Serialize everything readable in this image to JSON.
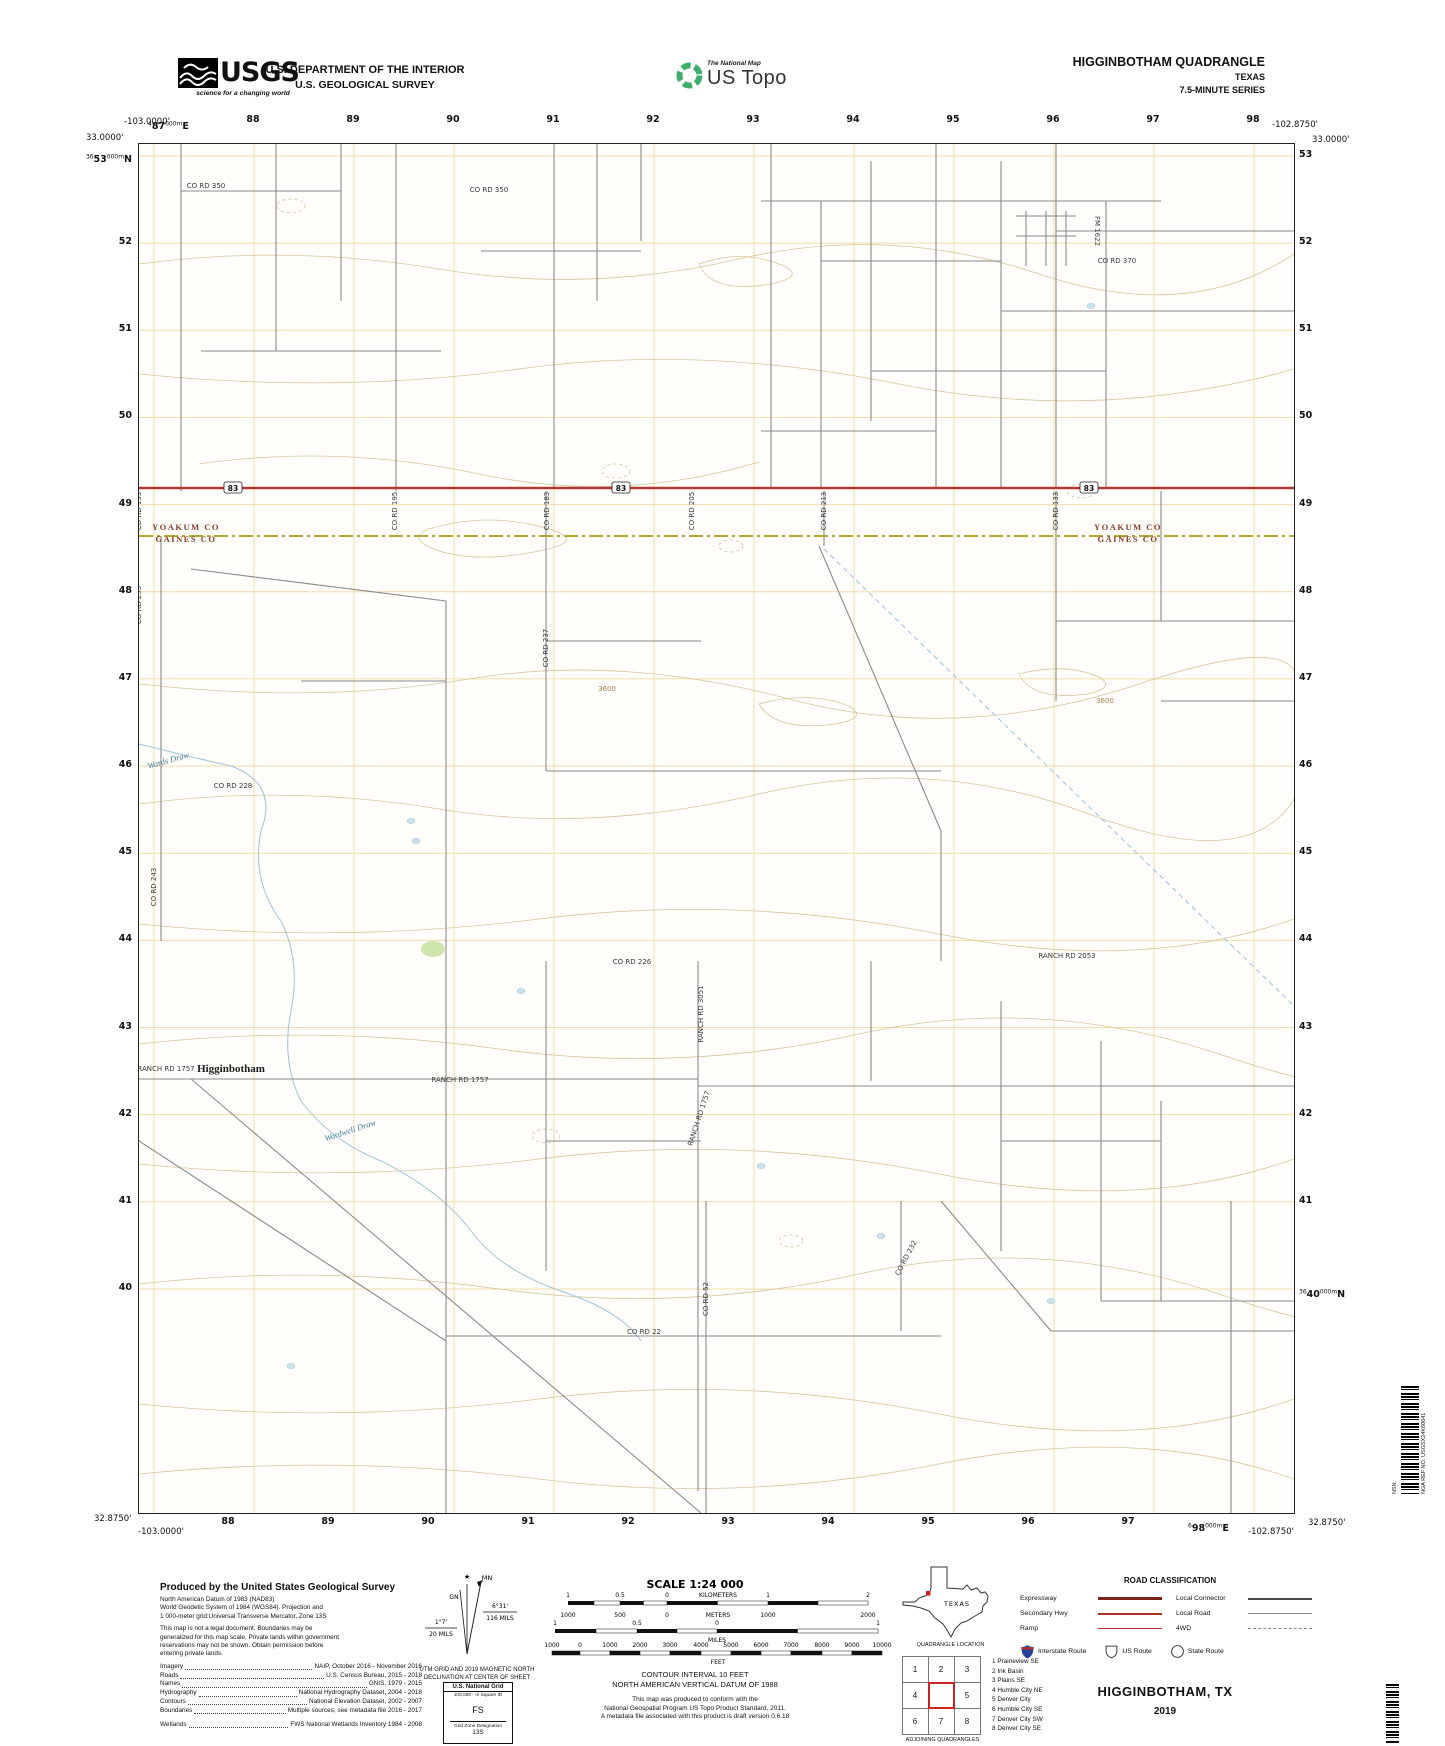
{
  "header": {
    "usgs_word": "USGS",
    "usgs_tagline": "science for a changing world",
    "dept_line1": "U.S. DEPARTMENT OF THE INTERIOR",
    "dept_line2": "U.S. GEOLOGICAL SURVEY",
    "ustopo_brand": "The National Map",
    "ustopo_name": "US Topo",
    "quad_title": "HIGGINBOTHAM QUADRANGLE",
    "quad_state": "TEXAS",
    "quad_series": "7.5-MINUTE SERIES"
  },
  "map": {
    "corners": {
      "top_left_lon": "-103.0000'",
      "top_left_lat": "33.0000'",
      "top_right_lon": "-102.8750'",
      "top_right_lat": "33.0000'",
      "bottom_left_lat": "32.8750'",
      "bottom_left_lon": "-103.0000'",
      "bottom_right_lon": "-102.8750'",
      "bottom_right_lat": "32.8750'"
    },
    "full_labels": {
      "top_left_easting": {
        "pre": "4",
        "big": "87",
        "sup": "000m",
        "post": "E"
      },
      "left_top_northing": {
        "pre": "36",
        "big": "53",
        "sup": "000m",
        "post": "N"
      },
      "bottom_right_easting": {
        "pre": "6",
        "big": "98",
        "sup": "000m",
        "post": "E"
      },
      "right_bottom_northing": {
        "pre": "36",
        "big": "40",
        "sup": "000m",
        "post": "N"
      }
    },
    "top_eastings": [
      "88",
      "89",
      "90",
      "91",
      "92",
      "93",
      "94",
      "95",
      "96",
      "97",
      "98"
    ],
    "bottom_eastings": [
      "88",
      "89",
      "90",
      "91",
      "92",
      "93",
      "94",
      "95",
      "96",
      "97"
    ],
    "left_northings": [
      "52",
      "51",
      "50",
      "49",
      "48",
      "47",
      "46",
      "45",
      "44",
      "43",
      "42",
      "41",
      "40"
    ],
    "right_northings": [
      "53",
      "52",
      "51",
      "50",
      "49",
      "48",
      "47",
      "46",
      "45",
      "44",
      "43",
      "42",
      "41"
    ],
    "route_shields": [
      {
        "label": "83",
        "x": 232,
        "y": 487
      },
      {
        "label": "83",
        "x": 620,
        "y": 487
      },
      {
        "label": "83",
        "x": 1088,
        "y": 487
      }
    ],
    "labels": [
      {
        "t": "CO RD 350",
        "x": 205,
        "y": 187,
        "r": 0,
        "c": "road"
      },
      {
        "t": "CO RD 350",
        "x": 488,
        "y": 191,
        "r": 0,
        "c": "road"
      },
      {
        "t": "FM 1622",
        "x": 1094,
        "y": 230,
        "r": 90,
        "c": "road"
      },
      {
        "t": "CO RD 370",
        "x": 1116,
        "y": 262,
        "r": 0,
        "c": "road"
      },
      {
        "t": "CO RD 155",
        "x": 140,
        "y": 510,
        "r": -90,
        "c": "road"
      },
      {
        "t": "CO RD 195",
        "x": 396,
        "y": 510,
        "r": -90,
        "c": "road"
      },
      {
        "t": "CO RD 183",
        "x": 548,
        "y": 510,
        "r": -90,
        "c": "road"
      },
      {
        "t": "CO RD 205",
        "x": 693,
        "y": 510,
        "r": -90,
        "c": "road"
      },
      {
        "t": "CO RD 213",
        "x": 825,
        "y": 510,
        "r": -90,
        "c": "road"
      },
      {
        "t": "CO RD 133",
        "x": 1057,
        "y": 510,
        "r": -90,
        "c": "road"
      },
      {
        "t": "YOAKUM CO",
        "x": 185,
        "y": 529,
        "r": 0,
        "c": "county"
      },
      {
        "t": "GAINES CO",
        "x": 185,
        "y": 541,
        "r": 0,
        "c": "county"
      },
      {
        "t": "YOAKUM CO",
        "x": 1127,
        "y": 529,
        "r": 0,
        "c": "county"
      },
      {
        "t": "GAINES CO",
        "x": 1127,
        "y": 541,
        "r": 0,
        "c": "county"
      },
      {
        "t": "CO RD 233",
        "x": 140,
        "y": 604,
        "r": -90,
        "c": "road"
      },
      {
        "t": "CO RD 237",
        "x": 547,
        "y": 647,
        "r": -90,
        "c": "road"
      },
      {
        "t": "3600",
        "x": 606,
        "y": 690,
        "r": 0,
        "c": "contour-label"
      },
      {
        "t": "3600",
        "x": 1104,
        "y": 702,
        "r": 0,
        "c": "contour-label"
      },
      {
        "t": "Wards Draw",
        "x": 168,
        "y": 762,
        "r": -16,
        "c": "hydro"
      },
      {
        "t": "CO RD 228",
        "x": 232,
        "y": 787,
        "r": 0,
        "c": "road"
      },
      {
        "t": "CO RD 243",
        "x": 155,
        "y": 886,
        "r": -90,
        "c": "road"
      },
      {
        "t": "CO RD 226",
        "x": 631,
        "y": 963,
        "r": 0,
        "c": "road"
      },
      {
        "t": "RANCH RD 2053",
        "x": 1066,
        "y": 957,
        "r": 0,
        "c": "road"
      },
      {
        "t": "RANCH RD 3051",
        "x": 702,
        "y": 1013,
        "r": -90,
        "c": "road"
      },
      {
        "t": "RANCH RD 1757",
        "x": 165,
        "y": 1070,
        "r": 0,
        "c": "road"
      },
      {
        "t": "Higginbotham",
        "x": 230,
        "y": 1071,
        "r": 0,
        "c": "town"
      },
      {
        "t": "RANCH RD 1757",
        "x": 459,
        "y": 1081,
        "r": 0,
        "c": "road"
      },
      {
        "t": "RANCH RD 1757",
        "x": 700,
        "y": 1118,
        "r": -72,
        "c": "road"
      },
      {
        "t": "Wardwell Draw",
        "x": 350,
        "y": 1132,
        "r": -18,
        "c": "hydro"
      },
      {
        "t": "CO RD 232",
        "x": 907,
        "y": 1258,
        "r": -62,
        "c": "road"
      },
      {
        "t": "CO RD 52",
        "x": 707,
        "y": 1298,
        "r": -90,
        "c": "road"
      },
      {
        "t": "CO RD 22",
        "x": 643,
        "y": 1333,
        "r": 0,
        "c": "road"
      }
    ]
  },
  "footer": {
    "produced": {
      "title": "Produced by the United States Geological Survey",
      "datum_lines": [
        "North American Datum of 1983 (NAD83)",
        "World Geodetic System of 1984 (WGS84).  Projection and",
        "1 000-meter grid:Universal Transverse Mercator, Zone 13S"
      ],
      "legal_lines": [
        "This map is not a legal document. Boundaries may be",
        "generalized for this map scale. Private lands within government",
        "reservations may not be shown. Obtain permission before",
        "entering private lands."
      ],
      "credits": [
        {
          "label": "Imagery",
          "value": "NAIP, October 2016 - November 2016"
        },
        {
          "label": "Roads",
          "value": "U.S. Census Bureau, 2015 - 2018"
        },
        {
          "label": "Names",
          "value": "GNIS, 1979 - 2015"
        },
        {
          "label": "Hydrography",
          "value": "National Hydrography Dataset, 2004 - 2018"
        },
        {
          "label": "Contours",
          "value": "National Elevation Dataset, 2002 - 2007"
        },
        {
          "label": "Boundaries",
          "value": "Multiple sources; see metadata file 2016 - 2017"
        },
        {
          "label": "Wetlands",
          "value": "FWS National Wetlands Inventory 1984 - 2008"
        }
      ]
    },
    "declination": {
      "mn_label": "MN",
      "gn_label": "GN",
      "star": "★",
      "mn_value": "6°31'",
      "mn_mils": "116 MILS",
      "gn_value": "1°7'",
      "gn_mils": "20 MILS",
      "caption_line1": "UTM GRID AND 2019 MAGNETIC NORTH",
      "caption_line2": "DECLINATION AT CENTER OF SHEET"
    },
    "usng": {
      "title": "U.S. National Grid",
      "sub": "100,000 - m Square ID",
      "square_id": "FS",
      "zone_label": "Grid Zone Designation",
      "zone": "13S"
    },
    "scale": {
      "title": "SCALE 1:24 000",
      "km_label": "KILOMETERS",
      "km_ticks": [
        "1",
        "0.5",
        "0",
        "1",
        "2"
      ],
      "m_label": "METERS",
      "m_ticks": [
        "1000",
        "500",
        "0",
        "1000",
        "2000"
      ],
      "mi_label": "MILES",
      "mi_ticks": [
        "1",
        "0.5",
        "0",
        "1"
      ],
      "ft_label": "FEET",
      "ft_ticks": [
        "1000",
        "0",
        "1000",
        "2000",
        "3000",
        "4000",
        "5000",
        "6000",
        "7000",
        "8000",
        "9000",
        "10000"
      ]
    },
    "contour": {
      "line1": "CONTOUR INTERVAL 10 FEET",
      "line2": "NORTH AMERICAN VERTICAL DATUM OF 1988",
      "line3": "This map was produced to conform with the",
      "line4": "National Geospatial Program US Topo Product Standard, 2011.",
      "line5": "A metadata file associated with this product is draft version 0.6.18"
    },
    "location": {
      "state_label": "TEXAS",
      "caption": "QUADRANGLE LOCATION"
    },
    "adjoining": {
      "grid_numbers": [
        "1",
        "2",
        "3",
        "4",
        "",
        "5",
        "6",
        "7",
        "8"
      ],
      "names": [
        "1 Prairieview SE",
        "2 Ink Basin",
        "3 Plains SE",
        "4 Humble City NE",
        "5 Denver City",
        "6 Humble City SE",
        "7 Denver City SW",
        "8 Denver City SE"
      ],
      "caption": "ADJOINING QUADRANGLES"
    },
    "road_class": {
      "title": "ROAD CLASSIFICATION",
      "rows_left": [
        {
          "label": "Expressway",
          "style": "expressway"
        },
        {
          "label": "Secondary Hwy",
          "style": "secondary"
        },
        {
          "label": "Ramp",
          "style": "ramp"
        }
      ],
      "rows_right": [
        {
          "label": "Local Connector",
          "style": "connector"
        },
        {
          "label": "Local Road",
          "style": "local"
        },
        {
          "label": "4WD",
          "style": "fourwd"
        }
      ],
      "shields": [
        {
          "label": "Interstate Route",
          "type": "interstate"
        },
        {
          "label": "US Route",
          "type": "us"
        },
        {
          "label": "State Route",
          "type": "state"
        }
      ]
    },
    "title_block": {
      "name": "HIGGINBOTHAM,  TX",
      "year": "2019"
    },
    "barcode": {
      "nsn_label": "NSN.",
      "nga_label": "NGA REF NO.",
      "nga_value": "USGSX24K60641"
    },
    "colors": {
      "highway_red": "#b03a30",
      "county_line": "#b5a730",
      "grid_orange": "#f2dcaa",
      "contour_tan": "#d8c59c",
      "water_blue": "#9cc5d8"
    }
  }
}
